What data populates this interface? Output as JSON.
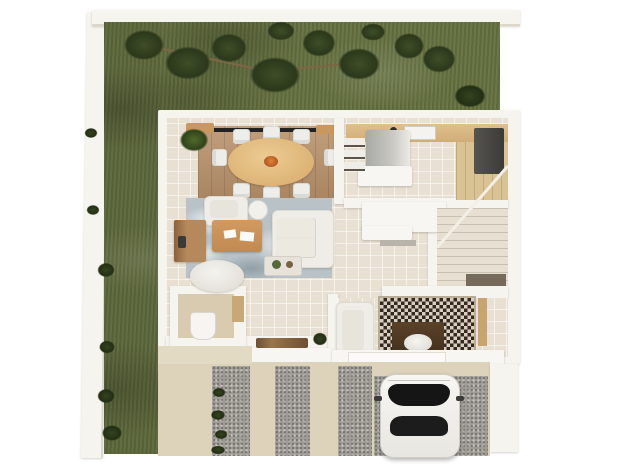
{
  "scene": {
    "description": "Top-down 3D architectural render of a ground-floor plan with side garden, interior rooms, striped driveway and carport with a parked car",
    "background": "#ffffff"
  },
  "palette": {
    "background": "#ffffff",
    "perimeter_wall": "#f6f4ef",
    "grass": "#64703f",
    "tree_foliage": "#2b381b",
    "interior_floor": "#e8e0d2",
    "dining_rug_wood": "#b8916b",
    "dining_table": "#e5bf84",
    "chair_white": "#edeeea",
    "marble_rug": "#b9c3c7",
    "sofa_white": "#efede7",
    "desk_wood": "#c69057",
    "sideboard_wood": "#b5895c",
    "kitchen_counter_wood": "#d8b783",
    "kitchen_island_gray": "#a8aaa6",
    "appliance_dark": "#474745",
    "stair_tread": "#e7e0d2",
    "mosaic_dark": "#33291f",
    "mosaic_light": "#d8cfc0",
    "console_wood": "#4e3824",
    "driveway_concrete": "#ddd2ba",
    "driveway_gravel": "#a09d96",
    "car_body": "#f2f1ee",
    "car_glass": "#151515",
    "window_rail": "#222222"
  },
  "garden": {
    "areas": [
      "top lawn",
      "left lawn strip"
    ],
    "elements": [
      "tree canopy clusters",
      "branches",
      "perimeter wall shrubs",
      "corner shrub"
    ]
  },
  "rooms": [
    {
      "name": "Dining Room",
      "furniture": [
        "oval dining table",
        "eight white chairs",
        "wood area rug",
        "black window rail",
        "wall wood decor",
        "potted plant"
      ]
    },
    {
      "name": "Living Room",
      "furniture": [
        "white sofa",
        "white armchair",
        "round side table",
        "wood desk with papers",
        "wood sideboard",
        "decor table",
        "oval white ottoman",
        "marble rug"
      ]
    },
    {
      "name": "Kitchen",
      "furniture": [
        "wood wall counter",
        "sink with faucet",
        "gray island",
        "white worktop",
        "three wall shelves",
        "dark appliance",
        "wood floor strip"
      ]
    },
    {
      "name": "Powder Room",
      "furniture": [
        "toilet",
        "door threshold"
      ]
    },
    {
      "name": "Hallway",
      "furniture": [
        "wood bench",
        "potted plant"
      ]
    },
    {
      "name": "Staircase",
      "furniture": [
        "winder stairs",
        "under-stair nook"
      ]
    },
    {
      "name": "Foyer",
      "furniture": [
        "mosaic rug",
        "dark console table",
        "round white tray",
        "white armchair",
        "wood threshold"
      ]
    },
    {
      "name": "Entrance Porch",
      "furniture": [
        "white door slab",
        "porch steps"
      ]
    }
  ],
  "exterior": {
    "driveway": {
      "pattern": "alternating concrete and gravel stripes",
      "gravel_stripe_count": 3,
      "plants": "small shrubs along first gravel stripe"
    },
    "carport": {
      "surface": "gravel pad",
      "vehicle": "white car seen from above with dark windshield and rear window"
    }
  }
}
